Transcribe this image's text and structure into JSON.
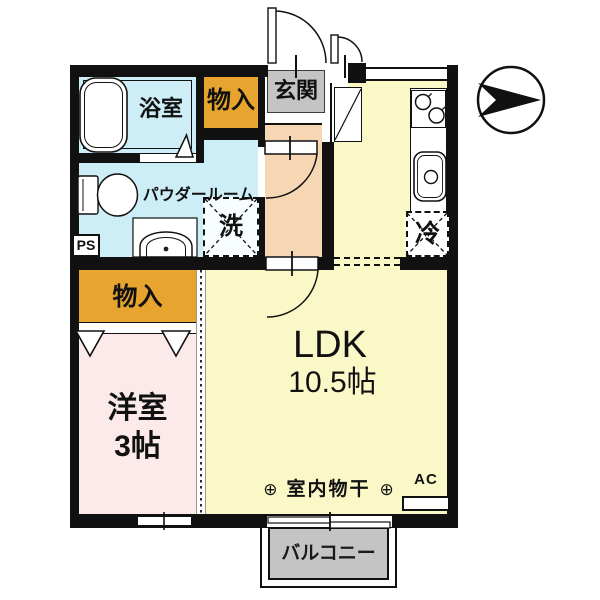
{
  "floorplan": {
    "compass": {
      "icon": "direction-arrow",
      "points": "right"
    },
    "rooms": {
      "bathroom": {
        "label": "浴室"
      },
      "storage_top": {
        "label": "物入"
      },
      "entrance": {
        "label": "玄関"
      },
      "powder_room": {
        "label": "パウダールーム"
      },
      "ldk": {
        "label": "LDK",
        "size": "10.5帖"
      },
      "storage_west": {
        "label": "物入"
      },
      "western_room": {
        "label": "洋室",
        "size": "3帖"
      },
      "balcony": {
        "label": "バルコニー"
      }
    },
    "fixtures": {
      "washing_machine": {
        "label": "洗"
      },
      "refrigerator": {
        "label": "冷"
      },
      "pipe_space": {
        "label": "PS"
      },
      "air_conditioner": {
        "label": "AC"
      }
    },
    "annotations": {
      "indoor_drying": {
        "label": "室内物干",
        "hook_symbol": "⊕"
      }
    },
    "colors": {
      "water_rooms": "#cdeef6",
      "ldk_floor": "#fbf8c8",
      "western_room_floor": "#fce9e9",
      "hall_floor": "#f7d6b4",
      "storage": "#e7a52f",
      "entrance_and_balcony": "#c4c4c4",
      "walls": "#111111"
    }
  }
}
